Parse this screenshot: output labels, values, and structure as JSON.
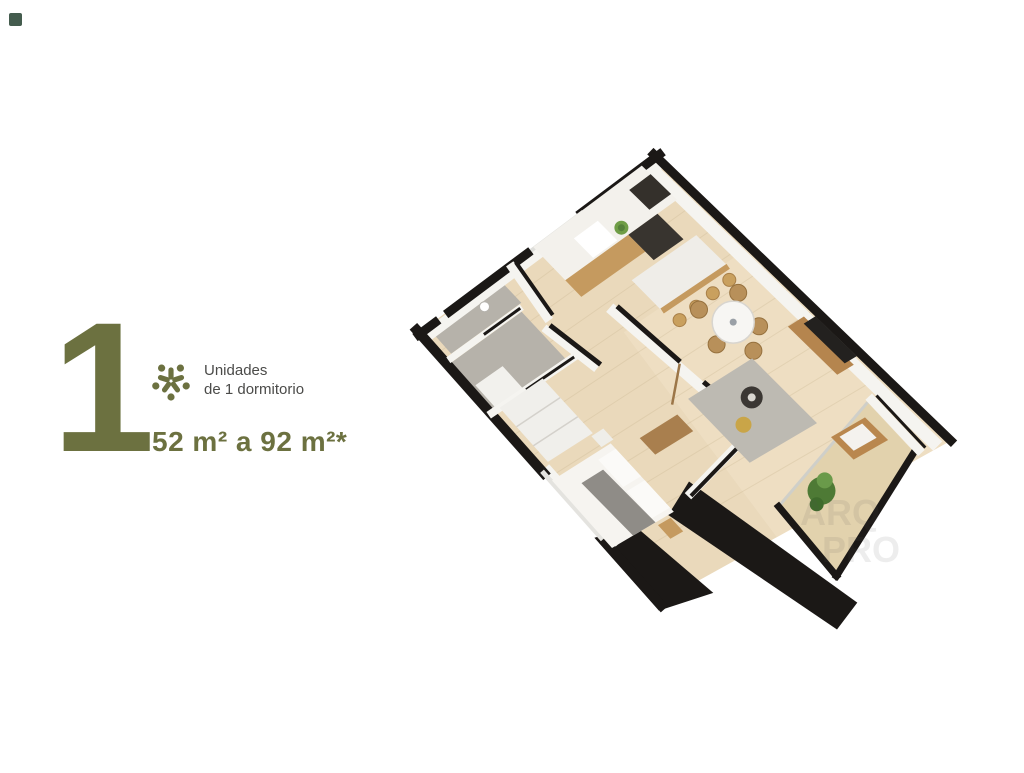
{
  "page": {
    "background": "#ffffff",
    "corner_mark_color": "#23402f"
  },
  "info_panel": {
    "big_number": "1",
    "label_line1": "Unidades",
    "label_line2": "de 1 dormitorio",
    "area_range": "52 m² a 92 m²*",
    "accent_color": "#6c7140",
    "text_color": "#4b4b49"
  },
  "floor_plan": {
    "description": "3D isometric render of a one-bedroom apartment floor plan, rotated diamond orientation",
    "watermark_line1": "ARQ",
    "watermark_line2": "PRO",
    "palette": {
      "wall_black": "#1b1816",
      "wall_white": "#f5f4f0",
      "floor_wood": "#ead9bb",
      "deck_wood": "#e2d2ad",
      "bathroom_tile": "#b6b2aa",
      "rug_gray": "#bdbab2",
      "wood_furniture": "#c59a5f",
      "plant_green": "#4e7a35"
    }
  }
}
